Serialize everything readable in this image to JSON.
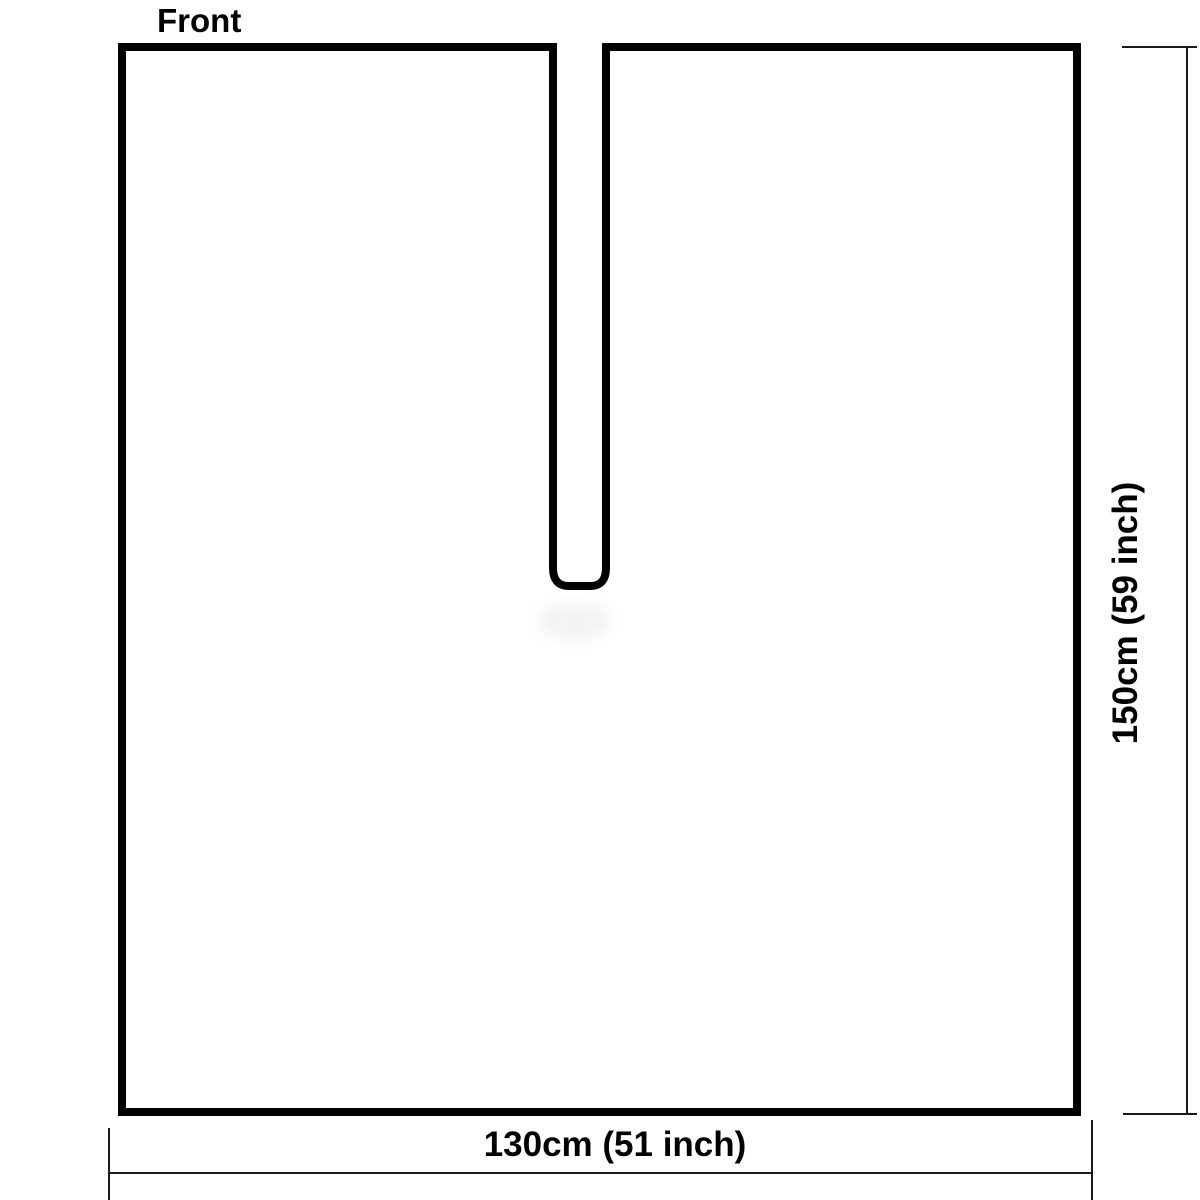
{
  "diagram": {
    "front_label": "Front",
    "bottom_dimension_label": "130cm (51 inch)",
    "right_dimension_label": "150cm (59 inch)"
  },
  "colors": {
    "background": "#ffffff",
    "outline": "#000000",
    "dimension_line": "#1a1a1a",
    "text": "#000000"
  }
}
